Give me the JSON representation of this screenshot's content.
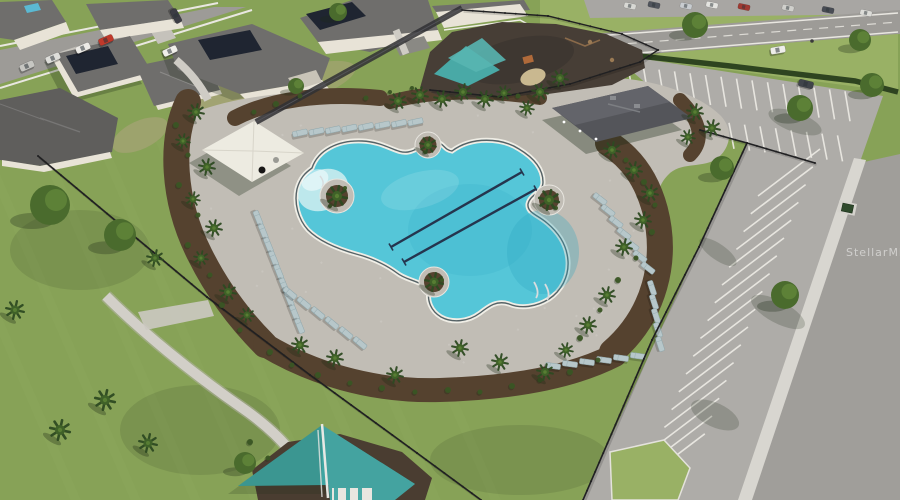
{
  "meta": {
    "domain": "Natural-Image",
    "description": "Aerial drone photo of a resort-style community pool amenity center: free-form pool with two lap lanes, sun loungers, palm landscaping, white shade canopy, clubhouse pavilion, playgrounds with teal shade sails, black perimeter fence, parking lot and surrounding residential streets.",
    "watermark": "StellarMLS"
  },
  "palette": {
    "grass_base": "#87a257",
    "grass_light": "#9ab46a",
    "grass_verge": "#99b165",
    "deck": "#c1bdb5",
    "coping": "#f0eee6",
    "water": "#55c6d8",
    "water_shallow": "#d7f0f1",
    "water_deep": "#2ea6c0",
    "pool_edge": "#2e3f46",
    "lane": "#25354e",
    "mulch": "#55422f",
    "playground_mulch": "#473e36",
    "asphalt_parking": "#aeaca8",
    "asphalt_road": "#a09e9a",
    "road_main": "#9d9b97",
    "farlot": "#a8a6a3",
    "stripe": "#eceae4",
    "sidewalk": "#d8d6d0",
    "path": "#d2cfc8",
    "roof": "#6f6e6c",
    "roof_dark": "#5f5e5c",
    "roof_pavilion": "#54555a",
    "wall": "#e8e3d7",
    "solar": "#1f2531",
    "fence": "#202022",
    "privacy_fence": "#303034",
    "hedge": "#2e4420",
    "sail": "#3fa5a2",
    "sail2": "#49a9a6",
    "canopy": "#edebe1",
    "lounger": "#b7c7ca",
    "lounger_edge": "#8fa6ab",
    "palm": "#2e4a22",
    "palm_mid": "#3f6128",
    "palm_light": "#577d33",
    "tree": "#4a6b2d",
    "tree_light": "#5f8439",
    "shrub": "#3a5524",
    "shadow": "#1e2a16",
    "watermark_color": "#ffffff"
  },
  "scene": {
    "pool": {
      "lane_count": 2
    },
    "loungerGroups": [
      {
        "x": 258,
        "y": 218,
        "dx": 5.2,
        "dy": 13.5,
        "n": 9,
        "angle": 68
      },
      {
        "x": 300,
        "y": 133,
        "dx": 16.5,
        "dy": -1.6,
        "n": 8,
        "angle": -12
      },
      {
        "x": 600,
        "y": 199,
        "dx": 8,
        "dy": 11.5,
        "n": 7,
        "angle": 38
      },
      {
        "x": 652,
        "y": 288,
        "dx": 2,
        "dy": 14,
        "n": 5,
        "angle": 72
      },
      {
        "x": 638,
        "y": 356,
        "dx": -17,
        "dy": 2,
        "n": 6,
        "angle": 8
      },
      {
        "x": 290,
        "y": 293,
        "dx": 14,
        "dy": 10,
        "n": 6,
        "angle": 40
      }
    ],
    "palms": [
      [
        337,
        196,
        10
      ],
      [
        428,
        145,
        8
      ],
      [
        434,
        282,
        9
      ],
      [
        549,
        200,
        10
      ],
      [
        398,
        101,
        8
      ],
      [
        420,
        95,
        8
      ],
      [
        442,
        99,
        8
      ],
      [
        463,
        92,
        8
      ],
      [
        485,
        99,
        8
      ],
      [
        504,
        93,
        7
      ],
      [
        196,
        112,
        8
      ],
      [
        183,
        141,
        7
      ],
      [
        207,
        167,
        8
      ],
      [
        193,
        199,
        7
      ],
      [
        214,
        228,
        8
      ],
      [
        201,
        258,
        7
      ],
      [
        228,
        292,
        8
      ],
      [
        247,
        315,
        7
      ],
      [
        300,
        345,
        8
      ],
      [
        335,
        358,
        8
      ],
      [
        395,
        375,
        8
      ],
      [
        460,
        348,
        8
      ],
      [
        500,
        362,
        8
      ],
      [
        545,
        372,
        8
      ],
      [
        612,
        150,
        8
      ],
      [
        634,
        170,
        8
      ],
      [
        650,
        193,
        8
      ],
      [
        643,
        220,
        8
      ],
      [
        624,
        247,
        8
      ],
      [
        607,
        295,
        8
      ],
      [
        588,
        325,
        8
      ],
      [
        566,
        350,
        7
      ],
      [
        540,
        92,
        8
      ],
      [
        560,
        78,
        8
      ],
      [
        527,
        108,
        7
      ],
      [
        695,
        112,
        8
      ],
      [
        712,
        128,
        8
      ],
      [
        688,
        137,
        7
      ],
      [
        15,
        310,
        9
      ],
      [
        60,
        430,
        10
      ],
      [
        105,
        400,
        10
      ],
      [
        148,
        443,
        9
      ],
      [
        155,
        258,
        8
      ]
    ],
    "trees": [
      [
        50,
        205,
        20
      ],
      [
        120,
        235,
        16
      ],
      [
        245,
        463,
        11
      ],
      [
        722,
        168,
        12
      ],
      [
        800,
        108,
        13
      ],
      [
        872,
        85,
        12
      ],
      [
        785,
        295,
        14
      ],
      [
        695,
        25,
        13
      ],
      [
        860,
        40,
        11
      ],
      [
        338,
        12,
        9
      ],
      [
        296,
        86,
        8
      ]
    ],
    "shrubs": [
      [
        176,
        125,
        3
      ],
      [
        188,
        155,
        2.5
      ],
      [
        179,
        185,
        3
      ],
      [
        198,
        215,
        2.5
      ],
      [
        188,
        245,
        3
      ],
      [
        210,
        275,
        2.5
      ],
      [
        222,
        305,
        3
      ],
      [
        240,
        330,
        2.5
      ],
      [
        270,
        352,
        3
      ],
      [
        292,
        365,
        2.5
      ],
      [
        318,
        375,
        3
      ],
      [
        350,
        383,
        2.5
      ],
      [
        382,
        388,
        3
      ],
      [
        415,
        392,
        2.5
      ],
      [
        448,
        390,
        3
      ],
      [
        480,
        392,
        2.5
      ],
      [
        512,
        386,
        3
      ],
      [
        540,
        380,
        2.5
      ],
      [
        570,
        372,
        3
      ],
      [
        598,
        360,
        2.5
      ],
      [
        626,
        160,
        2.5
      ],
      [
        644,
        182,
        3
      ],
      [
        655,
        205,
        2.5
      ],
      [
        652,
        232,
        3
      ],
      [
        636,
        258,
        2.5
      ],
      [
        618,
        280,
        3
      ],
      [
        600,
        310,
        2.5
      ],
      [
        580,
        338,
        3
      ],
      [
        366,
        98,
        2.5
      ],
      [
        390,
        92,
        2
      ],
      [
        412,
        88,
        2
      ],
      [
        518,
        96,
        2.5
      ],
      [
        300,
        96,
        2.5
      ],
      [
        276,
        104,
        3
      ],
      [
        254,
        112,
        2.5
      ],
      [
        330,
        206,
        2
      ],
      [
        345,
        188,
        2
      ],
      [
        425,
        152,
        2
      ],
      [
        442,
        280,
        2
      ],
      [
        556,
        208,
        2
      ],
      [
        250,
        442,
        3
      ],
      [
        268,
        458,
        2.5
      ]
    ],
    "cars": [
      {
        "x": 106,
        "y": 40,
        "a": -24,
        "c": "#c0392b"
      },
      {
        "x": 83,
        "y": 48,
        "a": -24,
        "c": "#eceae6"
      },
      {
        "x": 53,
        "y": 58,
        "a": -24,
        "c": "#dededa"
      },
      {
        "x": 27,
        "y": 66,
        "a": -24,
        "c": "#c6c6c2"
      },
      {
        "x": 170,
        "y": 51,
        "a": -25,
        "c": "#f0efe9"
      },
      {
        "x": 176,
        "y": 16,
        "a": 62,
        "c": "#3c3c44"
      },
      {
        "x": 806,
        "y": 84,
        "a": 14,
        "c": "#40444a"
      },
      {
        "x": 778,
        "y": 50,
        "a": -10,
        "c": "#eeeeea"
      }
    ],
    "farLotCars": [
      {
        "x": 630,
        "y": 6,
        "c": "#d8d8d4"
      },
      {
        "x": 654,
        "y": 5,
        "c": "#50545c"
      },
      {
        "x": 686,
        "y": 6,
        "c": "#c8ccd0"
      },
      {
        "x": 712,
        "y": 5,
        "c": "#e4e4e0"
      },
      {
        "x": 744,
        "y": 7,
        "c": "#a03a32"
      },
      {
        "x": 788,
        "y": 8,
        "c": "#d0d0cc"
      },
      {
        "x": 828,
        "y": 10,
        "c": "#484c54"
      },
      {
        "x": 866,
        "y": 13,
        "c": "#dcdcd8"
      }
    ],
    "fences": [
      {
        "name": "amenity-fence-left",
        "pts": [
          [
            38,
            156
          ],
          [
            207,
            297
          ],
          [
            310,
            375
          ],
          [
            417,
            453
          ],
          [
            481,
            500
          ]
        ],
        "w": 1.6
      },
      {
        "name": "amenity-fence-right-top",
        "pts": [
          [
            700,
            130
          ],
          [
            747,
            143
          ],
          [
            815,
            163
          ]
        ],
        "w": 1.6
      },
      {
        "name": "amenity-fence-right-long",
        "pts": [
          [
            747,
            143
          ],
          [
            699,
            247
          ],
          [
            652,
            340
          ],
          [
            583,
            500
          ]
        ],
        "w": 1.6
      },
      {
        "name": "playground-fence-front",
        "pts": [
          [
            430,
            90
          ],
          [
            500,
            97
          ],
          [
            570,
            84
          ],
          [
            640,
            62
          ]
        ],
        "w": 1.4
      },
      {
        "name": "playground-fence-back",
        "pts": [
          [
            462,
            10
          ],
          [
            548,
            16
          ],
          [
            622,
            34
          ],
          [
            658,
            50
          ],
          [
            640,
            62
          ]
        ],
        "w": 1.4
      },
      {
        "name": "privacy-fence",
        "pts": [
          [
            256,
            122
          ],
          [
            462,
            8
          ]
        ],
        "w": 6,
        "privacy": true
      }
    ],
    "stripeGroups": [
      {
        "x": 628,
        "y": 66,
        "dx": 15.5,
        "dy": 1.8,
        "n": 15,
        "vx": 5,
        "vy": 30
      },
      {
        "x": 636,
        "y": 112,
        "dx": 15.5,
        "dy": 1.8,
        "n": 14,
        "vx": 5,
        "vy": 26
      },
      {
        "x": 758,
        "y": 196,
        "dx": -7.2,
        "dy": 17.8,
        "n": 17,
        "vx": 62,
        "vy": -47
      }
    ]
  }
}
